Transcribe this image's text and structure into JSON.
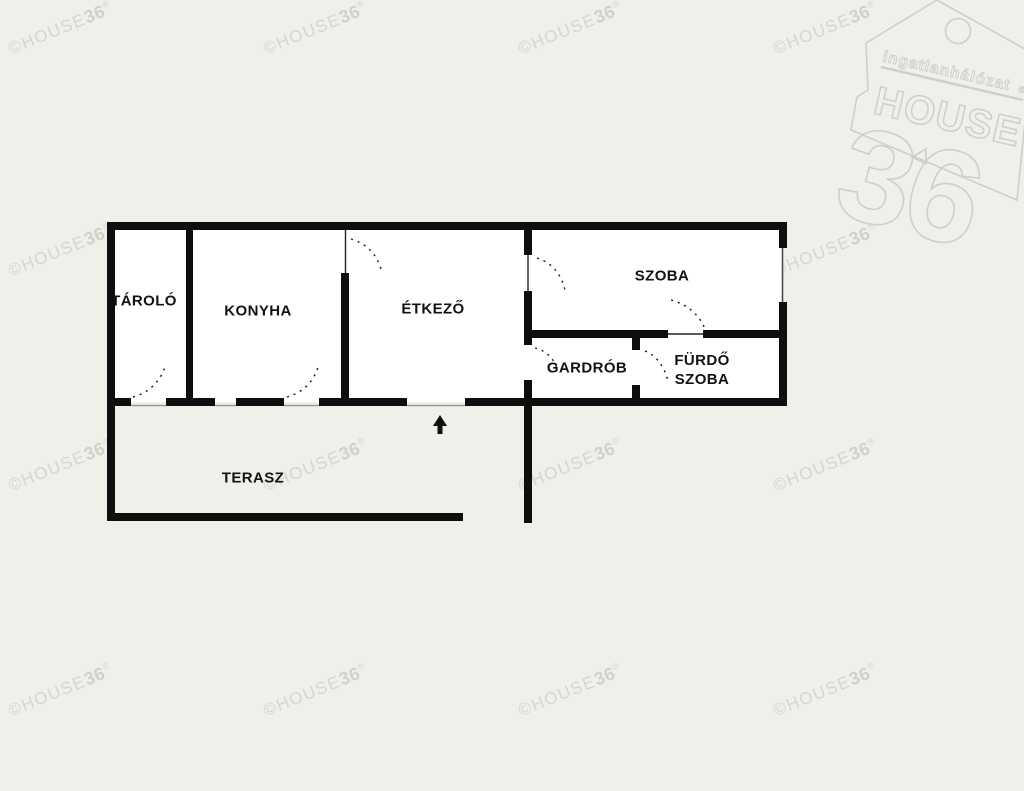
{
  "page": {
    "background": "#f0efe9",
    "room_fill": "#ffffff",
    "wall_color": "#0e0e0e"
  },
  "watermark": {
    "prefix": "©HOUSE",
    "bold": "36",
    "reg": "®"
  },
  "logo": {
    "tagline": "ingatlanhálózat",
    "name": "HOUSE",
    "number": "36",
    "reg": "®",
    "color": "#cfcec8"
  },
  "floorplan": {
    "rooms": {
      "tarolo": "TÁROLÓ",
      "konyha": "KONYHA",
      "etkezo": "ÉTKEZŐ",
      "szoba": "SZOBA",
      "gardrob": "GARDRÓB",
      "furdo_line1": "FÜRDŐ",
      "furdo_line2": "SZOBA",
      "terasz": "TERASZ"
    }
  }
}
